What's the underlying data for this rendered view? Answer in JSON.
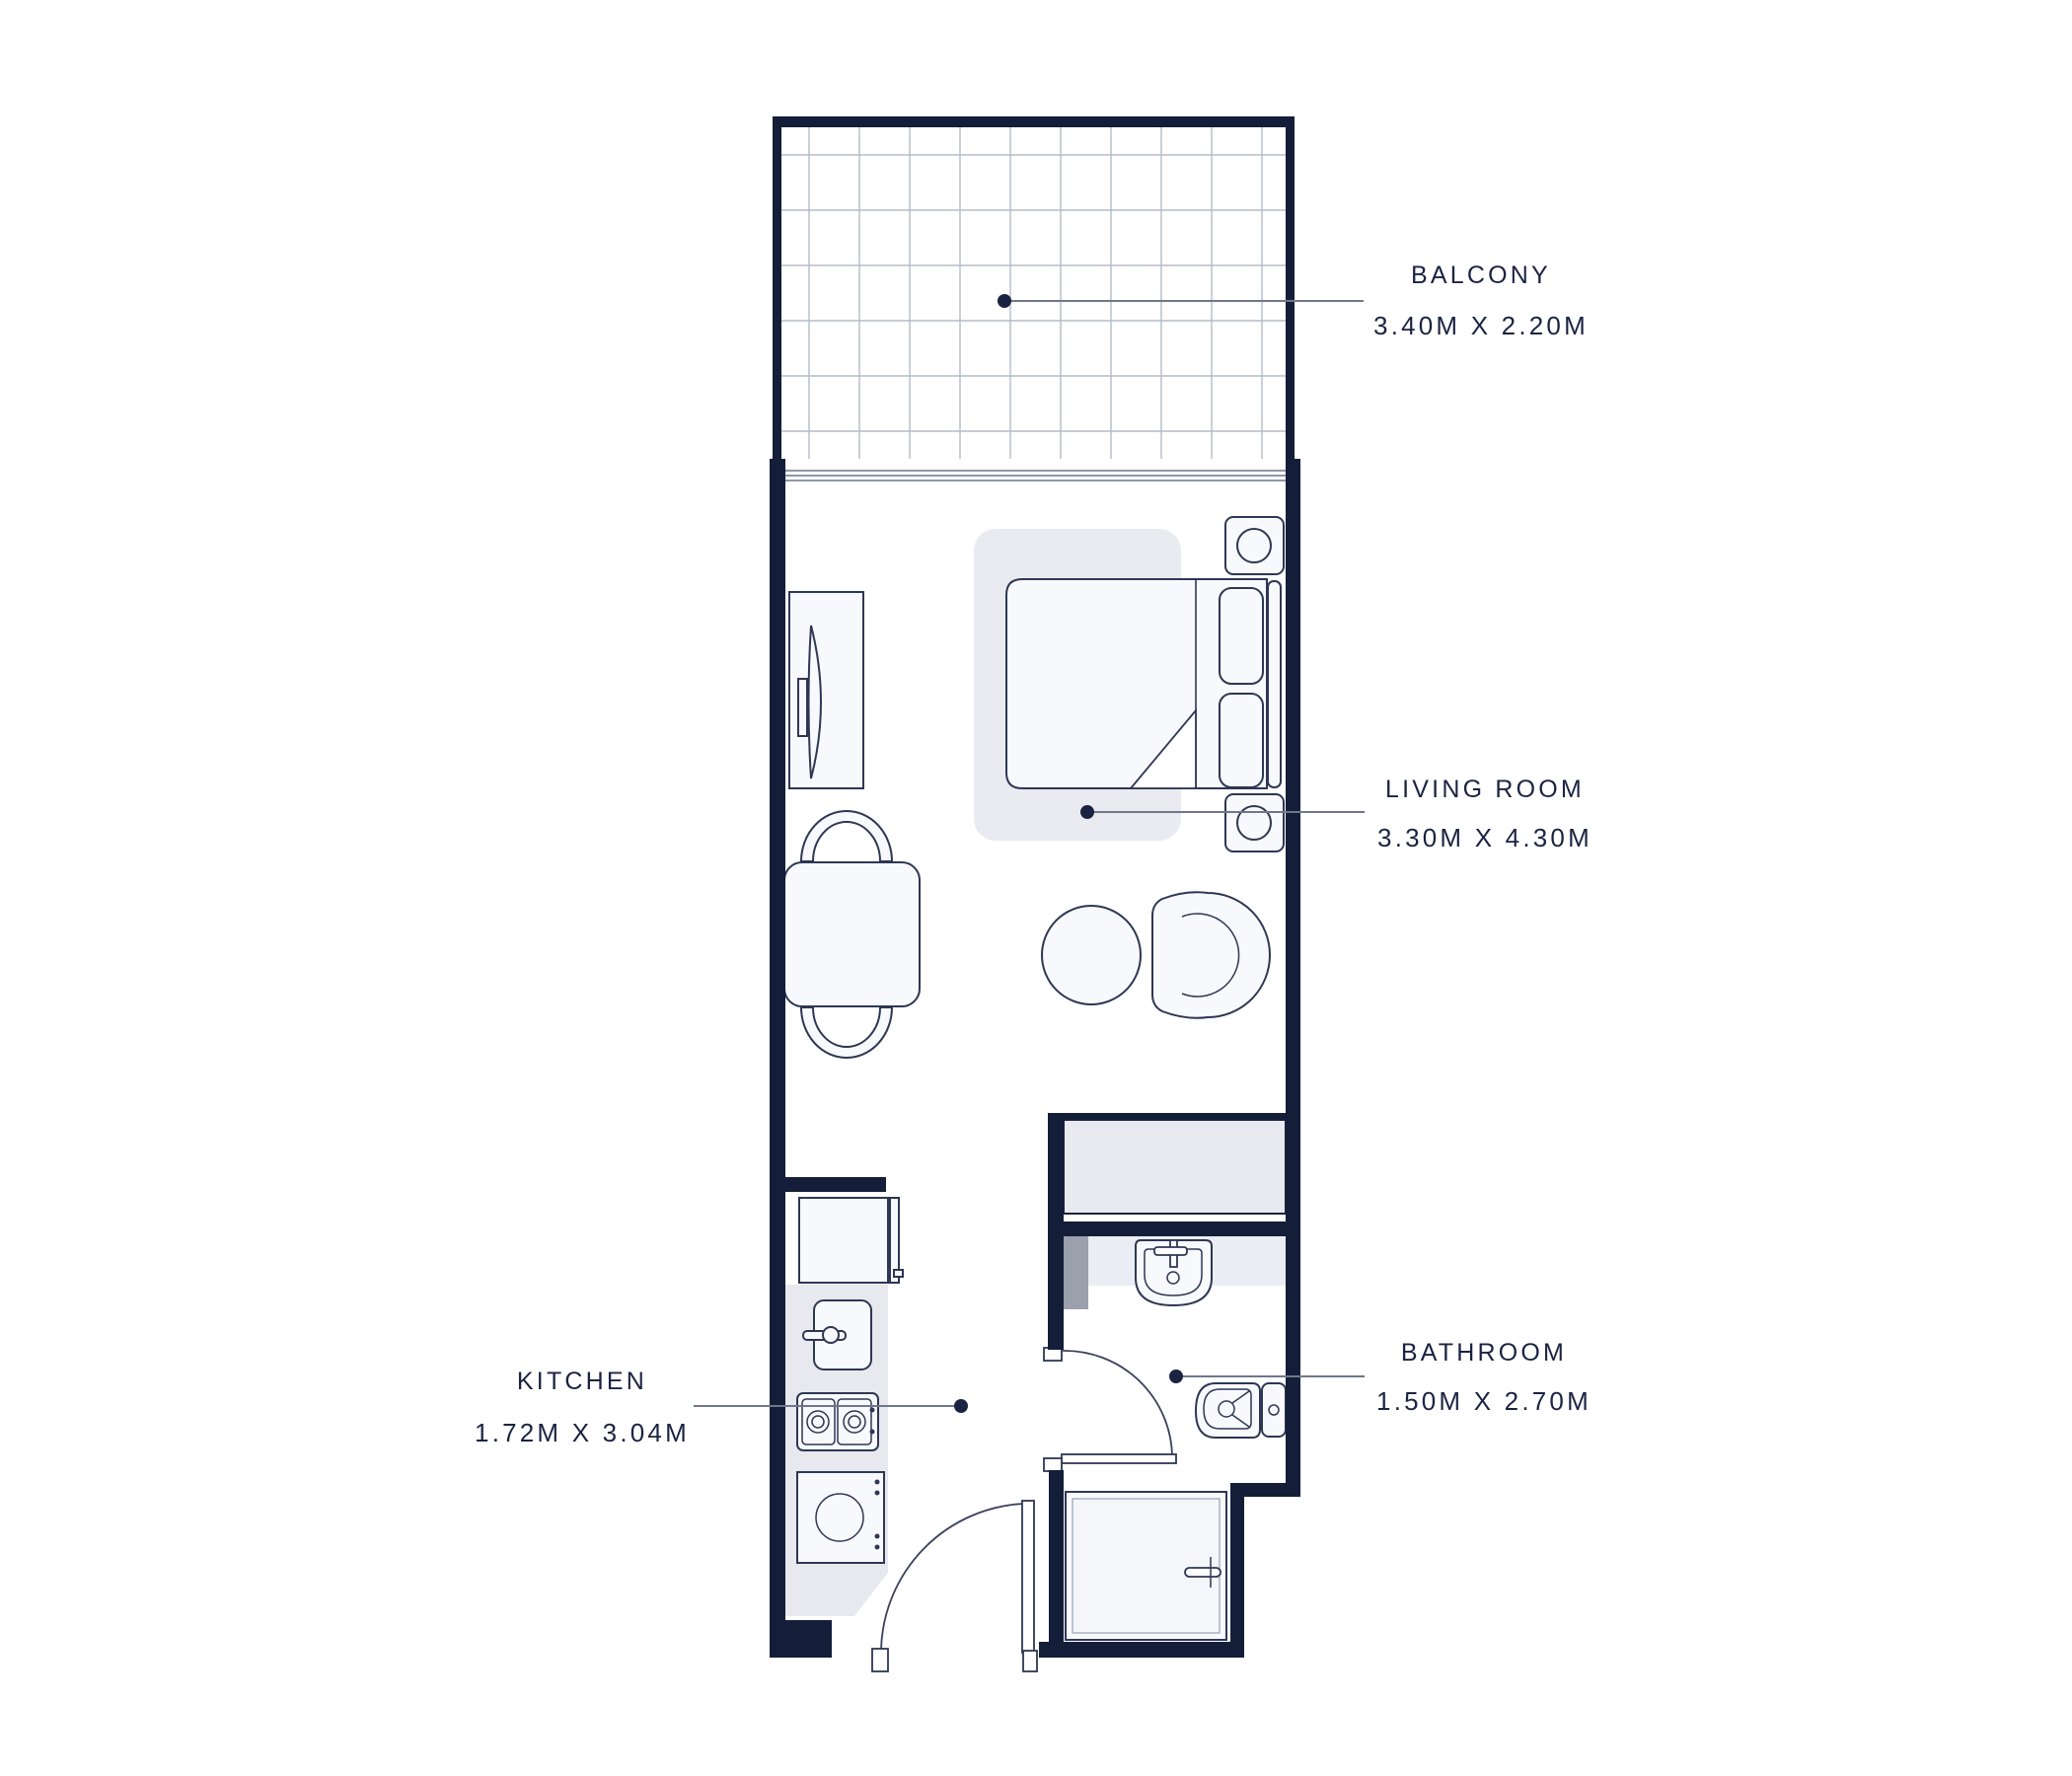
{
  "plan": {
    "type": "apartment-floor-plan",
    "rooms": {
      "balcony": {
        "name": "BALCONY",
        "dimensions": "3.40M X 2.20M"
      },
      "living_room": {
        "name": "LIVING ROOM",
        "dimensions": "3.30M X 4.30M"
      },
      "kitchen": {
        "name": "KITCHEN",
        "dimensions": "1.72M X 3.04M"
      },
      "bathroom": {
        "name": "BATHROOM",
        "dimensions": "1.50M X 2.70M"
      }
    },
    "colors": {
      "wall": "#141e38",
      "label_text": "#1b2342",
      "leader_line": "#70778a",
      "furniture_outline": "#2e3754",
      "furniture_fill": "#f8f9fc",
      "rug_fill": "#e9ebf1",
      "counter_fill": "#e7e9ee",
      "shower_fill": "#e8eaf0",
      "vanity_fill": "#eaedf3",
      "partition_fill": "#9aa0ac",
      "tile_grid": "#b5bbc7",
      "glazing": "#8f97a6"
    },
    "symbols": [
      "balcony-tiles",
      "double-bed",
      "rug",
      "pillows",
      "nightstand-lamps",
      "tv-console",
      "dining-table",
      "dining-chairs",
      "pouf",
      "armchair",
      "fridge-cabinet",
      "kitchen-sink",
      "stove",
      "washing-machine",
      "shower",
      "bathroom-sink",
      "toilet",
      "door-swings",
      "wardrobe"
    ]
  }
}
